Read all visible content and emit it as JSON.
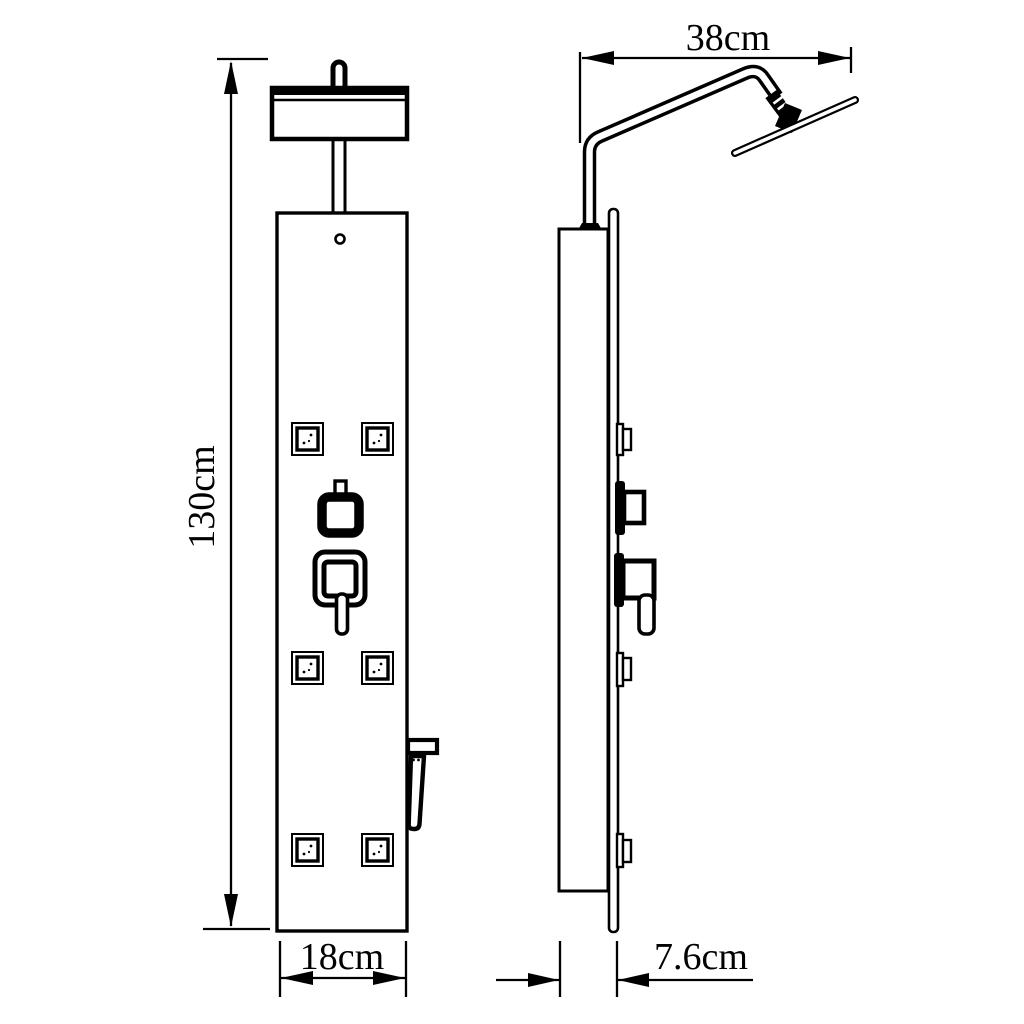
{
  "colors": {
    "background": "#ffffff",
    "line": "#000000"
  },
  "drawing": {
    "kind": "technical-dimension-drawing",
    "subject": "shower panel column, front view and side view"
  },
  "dimensions": {
    "height": "130cm",
    "panel_width": "18cm",
    "arm_reach": "38cm",
    "panel_depth": "7.6cm"
  }
}
